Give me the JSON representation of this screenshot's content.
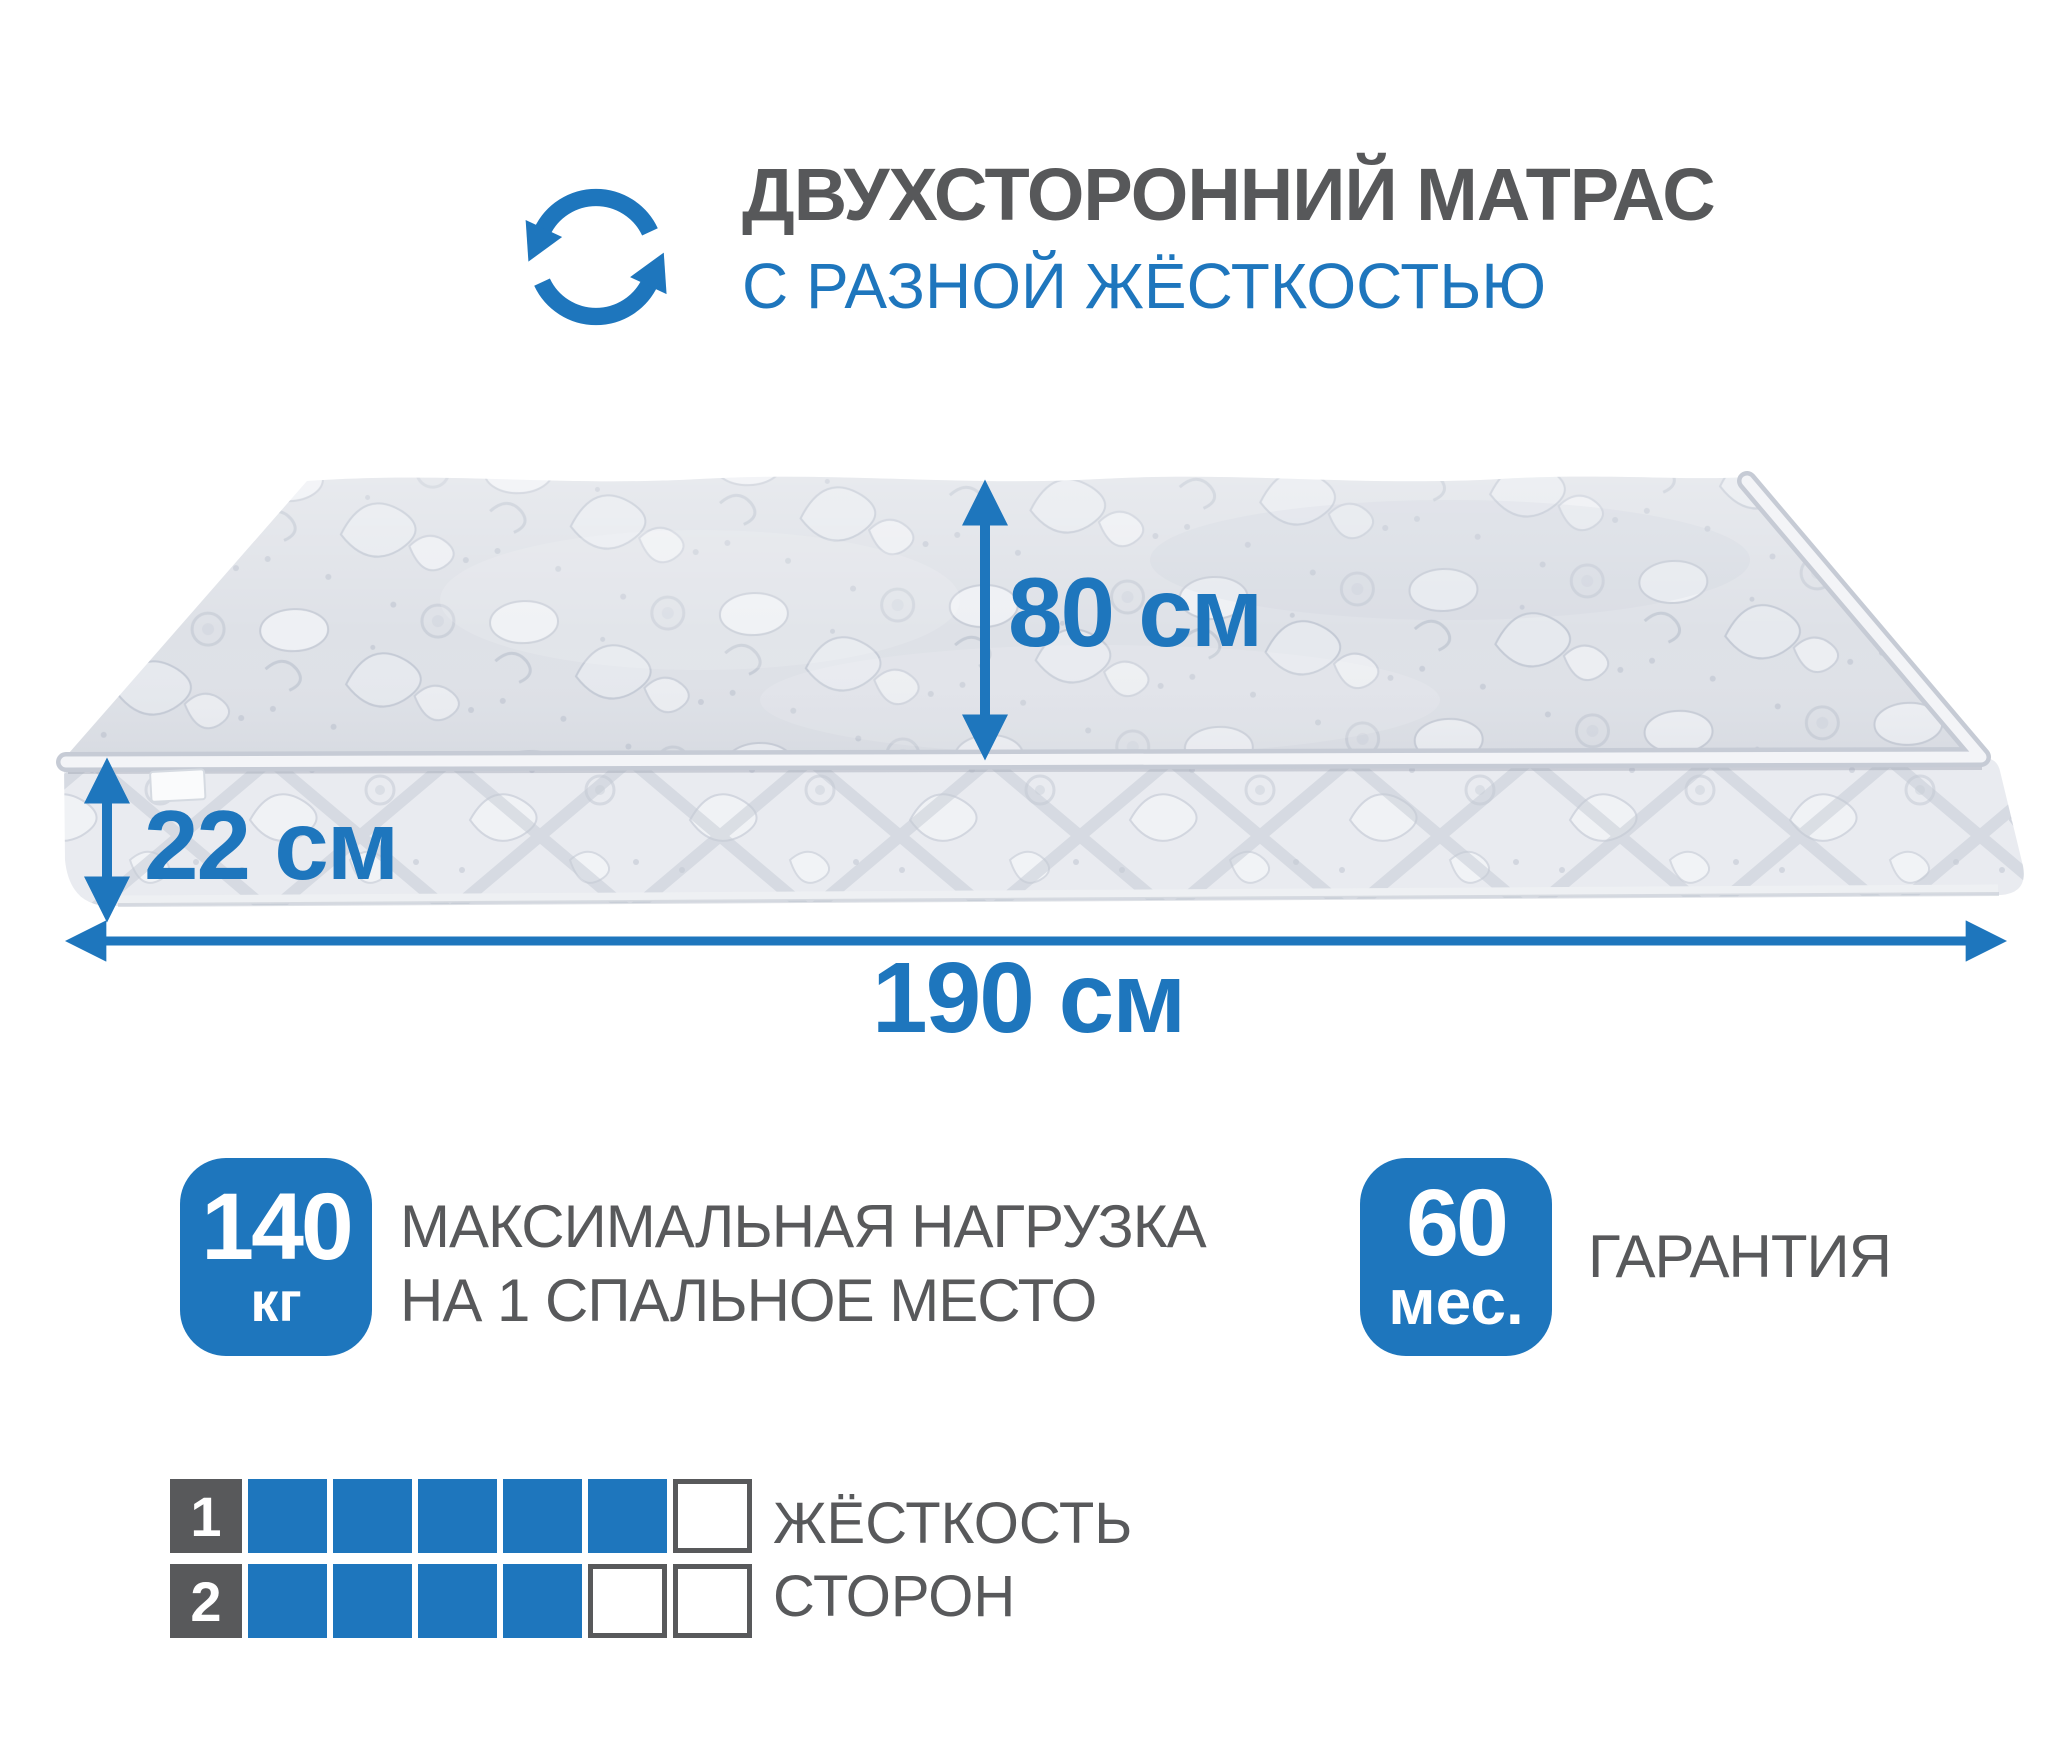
{
  "header": {
    "title": "ДВУХСТОРОННИЙ МАТРАС",
    "subtitle": "С РАЗНОЙ ЖЁСТКОСТЬЮ",
    "icon": "rotate-arrows-icon"
  },
  "dimensions": {
    "bed_width": "80 см",
    "mattress_height": "22 см",
    "bed_length": "190 см"
  },
  "load_badge": {
    "value": "140",
    "unit": "кг",
    "label_line1": "МАКСИМАЛЬНАЯ НАГРУЗКА",
    "label_line2": "НА 1 СПАЛЬНОЕ МЕСТО"
  },
  "warranty_badge": {
    "value": "60",
    "unit": "мес.",
    "label": "ГАРАНТИЯ"
  },
  "firmness": {
    "label_line1": "ЖЁСТКОСТЬ",
    "label_line2": "СТОРОН",
    "rows": [
      {
        "side": "1",
        "filled": 5,
        "total": 6
      },
      {
        "side": "2",
        "filled": 4,
        "total": 6
      }
    ]
  },
  "colors": {
    "accent_blue": "#1e76bd",
    "text_gray": "#58595b",
    "mattress_top": "#dee1e7",
    "mattress_side": "#e9ebf0"
  }
}
